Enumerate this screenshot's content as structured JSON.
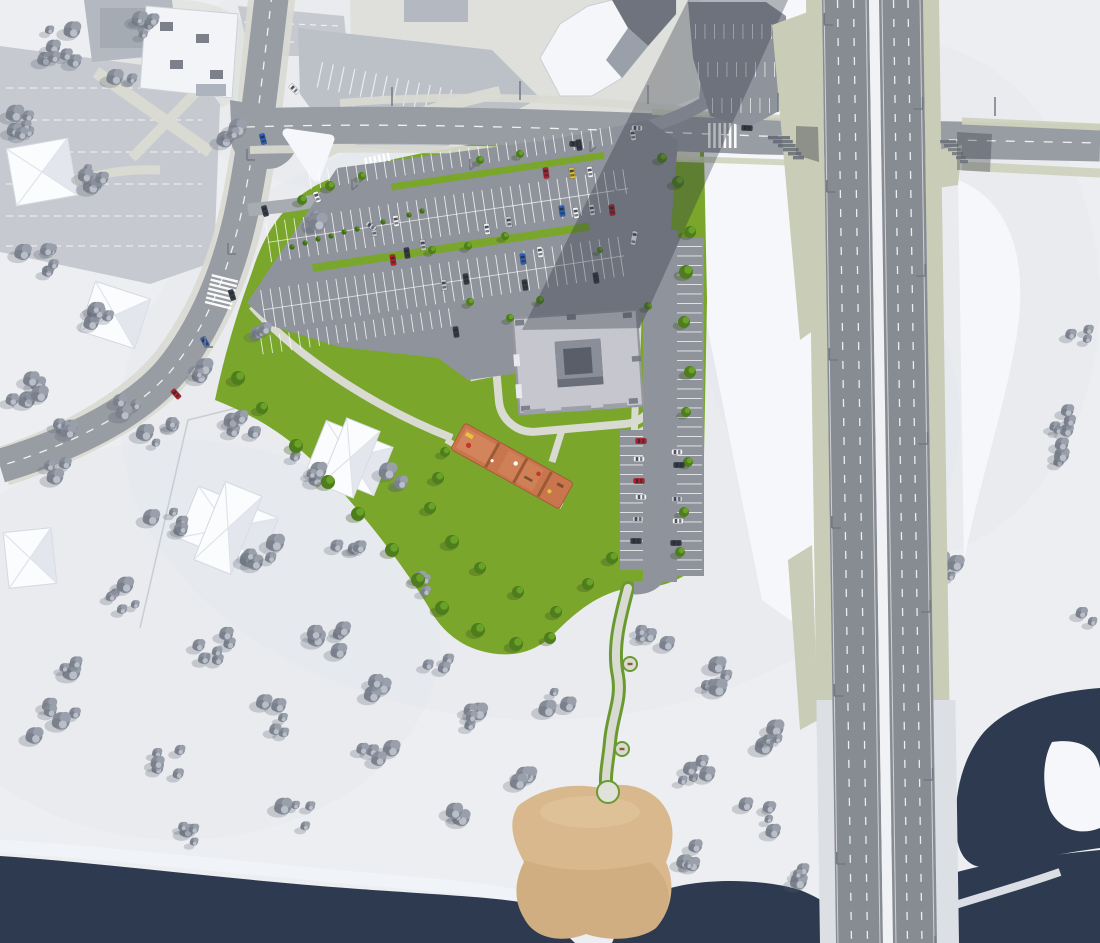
{
  "scene": {
    "description": "aerial-3d-site-plan-render",
    "season": "winter",
    "elements": [
      "river",
      "sand-beach",
      "elevated-highway-bridge",
      "parking-lot",
      "courtyard-apartment-building",
      "playground",
      "winding-riverside-path",
      "context-houses",
      "roads-with-crosswalks"
    ]
  },
  "colors": {
    "snow": "#eceef1",
    "snow_light": "#f5f7fa",
    "snow_shade": "#e0e4ea",
    "water": "#2d3a50",
    "sand": "#d8b88c",
    "sand_dark": "#c7a173",
    "sand_light": "#e2c79e",
    "grass": "#79a62b",
    "grass_dark": "#5e8f22",
    "bush": "#3f6b1a",
    "tree_green": "#4e7d1d",
    "tree_green_hi": "#6aa228",
    "tree_gray": "#868c97",
    "tree_gray_hi": "#b9bfc9",
    "tree_gray_dark": "#7b818c",
    "asphalt": "#8f939b",
    "asphalt_light": "#a7abb2",
    "road": "#989ca3",
    "bridge_road": "#878c93",
    "old_lot": "#c6cad0",
    "angle_lot": "#bcc0c7",
    "khaki": "#c9ccb6",
    "marking": "#f2f4f6",
    "walk": "#d9dad2",
    "plaza": "#dadbd3",
    "shadow": "rgba(45,51,64,0.34)",
    "roof": "#c6c6ce",
    "roof_edge": "#97979f",
    "court_dark": "#6a6e79",
    "court_mid": "#8a8e99",
    "court_hole": "#5a5e68",
    "bldg_white": "#f3f4f7",
    "roof_gray": "#b4b9c1",
    "roof_dark": "#6e737d",
    "house": "#fbfcfe",
    "house_shade": "#dde1e9",
    "pg_base": "#c9764f",
    "pg_light": "#d88a5f",
    "pg_red": "#c03a2b",
    "pg_yellow": "#e5c33c",
    "pg_brown": "#7d4f2e",
    "median": "#f0f2f5",
    "deck_edge": "#dcdfe4",
    "pole": "#747983"
  },
  "cars": {
    "palette": {
      "white": "#f4f5f7",
      "silver": "#c6cad1",
      "dark": "#383c44",
      "red": "#c01f2a",
      "yellow": "#e6c430",
      "blue": "#2b62c4"
    },
    "items": [
      [
        374,
        231,
        82,
        "silver",
        11
      ],
      [
        396,
        221,
        82,
        "white",
        11
      ],
      [
        487,
        229,
        82,
        "white",
        11
      ],
      [
        509,
        222,
        82,
        "silver",
        11
      ],
      [
        407,
        253,
        82,
        "dark",
        11
      ],
      [
        423,
        245,
        82,
        "silver",
        11
      ],
      [
        393,
        260,
        82,
        "red",
        11
      ],
      [
        523,
        259,
        82,
        "blue",
        11
      ],
      [
        540,
        252,
        82,
        "white",
        11
      ],
      [
        466,
        279,
        82,
        "dark",
        11
      ],
      [
        444,
        285,
        82,
        "silver",
        11
      ],
      [
        525,
        285,
        82,
        "dark",
        11
      ],
      [
        456,
        332,
        82,
        "dark",
        11
      ],
      [
        546,
        173,
        82,
        "red",
        11
      ],
      [
        572,
        173,
        82,
        "yellow",
        11
      ],
      [
        590,
        172,
        82,
        "white",
        11
      ],
      [
        592,
        210,
        82,
        "white",
        11
      ],
      [
        562,
        211,
        82,
        "blue",
        11
      ],
      [
        576,
        213,
        82,
        "white",
        11
      ],
      [
        612,
        210,
        82,
        "red",
        11
      ],
      [
        579,
        145,
        82,
        "dark",
        11
      ],
      [
        633,
        135,
        82,
        "white",
        11
      ],
      [
        596,
        278,
        82,
        "dark",
        11
      ],
      [
        634,
        238,
        100,
        "white",
        14
      ],
      [
        641,
        441,
        0,
        "red",
        11
      ],
      [
        639,
        459,
        0,
        "white",
        11
      ],
      [
        639,
        481,
        0,
        "red",
        11
      ],
      [
        641,
        497,
        0,
        "white",
        11
      ],
      [
        638,
        519,
        0,
        "silver",
        11
      ],
      [
        636,
        541,
        0,
        "dark",
        11
      ],
      [
        677,
        452,
        0,
        "white",
        11
      ],
      [
        679,
        465,
        0,
        "dark",
        11
      ],
      [
        677,
        499,
        0,
        "silver",
        11
      ],
      [
        678,
        521,
        0,
        "white",
        11
      ],
      [
        676,
        543,
        0,
        "dark",
        11
      ],
      [
        263,
        139,
        75,
        "blue",
        11
      ],
      [
        265,
        211,
        75,
        "dark",
        11
      ],
      [
        232,
        295,
        72,
        "dark",
        11
      ],
      [
        205,
        342,
        62,
        "blue",
        11
      ],
      [
        176,
        394,
        48,
        "red",
        11
      ],
      [
        317,
        197,
        70,
        "white",
        11
      ],
      [
        294,
        89,
        45,
        "white",
        11
      ],
      [
        371,
        226,
        35,
        "silver",
        11
      ],
      [
        637,
        128,
        2,
        "white",
        11
      ],
      [
        575,
        144,
        2,
        "dark",
        11
      ],
      [
        747,
        128,
        2,
        "dark",
        11
      ]
    ]
  },
  "vegetation": {
    "gray_clusters": [
      [
        55,
        45,
        7,
        40
      ],
      [
        140,
        28,
        5,
        26
      ],
      [
        25,
        120,
        6,
        32
      ],
      [
        90,
        178,
        6,
        36
      ],
      [
        38,
        258,
        5,
        34
      ],
      [
        100,
        318,
        5,
        30
      ],
      [
        28,
        392,
        5,
        36
      ],
      [
        120,
        70,
        3,
        24
      ],
      [
        230,
        132,
        3,
        20
      ],
      [
        320,
        222,
        3,
        18
      ],
      [
        262,
        332,
        3,
        16
      ],
      [
        205,
        372,
        3,
        16
      ],
      [
        60,
        430,
        4,
        30
      ],
      [
        130,
        404,
        3,
        22
      ],
      [
        158,
        432,
        5,
        30
      ],
      [
        248,
        420,
        5,
        34
      ],
      [
        306,
        468,
        4,
        28
      ],
      [
        168,
        520,
        5,
        34
      ],
      [
        258,
        558,
        5,
        36
      ],
      [
        348,
        540,
        4,
        30
      ],
      [
        118,
        598,
        5,
        36
      ],
      [
        218,
        648,
        6,
        40
      ],
      [
        326,
        640,
        5,
        36
      ],
      [
        420,
        582,
        3,
        24
      ],
      [
        438,
        668,
        3,
        22
      ],
      [
        398,
        478,
        3,
        22
      ],
      [
        60,
        470,
        3,
        22
      ],
      [
        55,
        722,
        5,
        44
      ],
      [
        158,
        760,
        5,
        44
      ],
      [
        276,
        718,
        5,
        40
      ],
      [
        376,
        758,
        4,
        36
      ],
      [
        472,
        720,
        4,
        30
      ],
      [
        298,
        820,
        4,
        40
      ],
      [
        178,
        838,
        4,
        36
      ],
      [
        516,
        778,
        3,
        24
      ],
      [
        556,
        700,
        3,
        24
      ],
      [
        456,
        818,
        3,
        22
      ],
      [
        64,
        662,
        3,
        26
      ],
      [
        380,
        690,
        3,
        24
      ],
      [
        652,
        638,
        4,
        30
      ],
      [
        716,
        678,
        5,
        36
      ],
      [
        698,
        768,
        5,
        36
      ],
      [
        756,
        818,
        5,
        36
      ],
      [
        688,
        858,
        4,
        30
      ],
      [
        774,
        738,
        4,
        26
      ],
      [
        856,
        778,
        4,
        30
      ],
      [
        896,
        838,
        3,
        26
      ],
      [
        806,
        878,
        3,
        22
      ],
      [
        1062,
        416,
        5,
        36
      ],
      [
        1078,
        330,
        3,
        22
      ],
      [
        952,
        566,
        4,
        28
      ],
      [
        1070,
        452,
        3,
        24
      ],
      [
        1086,
        620,
        2,
        18
      ]
    ],
    "green_trees": [
      [
        238,
        378,
        7
      ],
      [
        262,
        408,
        6
      ],
      [
        296,
        446,
        7
      ],
      [
        328,
        482,
        7
      ],
      [
        358,
        514,
        7
      ],
      [
        392,
        550,
        7
      ],
      [
        418,
        580,
        7
      ],
      [
        442,
        608,
        7
      ],
      [
        478,
        630,
        7
      ],
      [
        516,
        644,
        7
      ],
      [
        550,
        638,
        6
      ],
      [
        438,
        478,
        6
      ],
      [
        430,
        508,
        6
      ],
      [
        452,
        542,
        7
      ],
      [
        480,
        568,
        6
      ],
      [
        518,
        592,
        6
      ],
      [
        556,
        612,
        6
      ],
      [
        588,
        584,
        6
      ],
      [
        612,
        558,
        6
      ],
      [
        445,
        452,
        5
      ],
      [
        510,
        318,
        4
      ],
      [
        648,
        306,
        4
      ],
      [
        678,
        182,
        6
      ],
      [
        690,
        232,
        6
      ],
      [
        686,
        272,
        7
      ],
      [
        684,
        322,
        6
      ],
      [
        690,
        372,
        6
      ],
      [
        686,
        412,
        5
      ],
      [
        688,
        462,
        5
      ],
      [
        684,
        512,
        5
      ],
      [
        680,
        552,
        5
      ],
      [
        662,
        158,
        5
      ],
      [
        302,
        200,
        5
      ],
      [
        330,
        186,
        5
      ],
      [
        362,
        176,
        4
      ],
      [
        505,
        236,
        4
      ],
      [
        468,
        246,
        4
      ],
      [
        540,
        300,
        4
      ],
      [
        470,
        302,
        4
      ],
      [
        600,
        250,
        3
      ],
      [
        480,
        160,
        4
      ],
      [
        520,
        154,
        4
      ],
      [
        432,
        250,
        4
      ]
    ],
    "bushes": [
      [
        292,
        247
      ],
      [
        305,
        243
      ],
      [
        318,
        239
      ],
      [
        331,
        236
      ],
      [
        344,
        232
      ],
      [
        357,
        229
      ],
      [
        370,
        225
      ],
      [
        383,
        222
      ],
      [
        396,
        218
      ],
      [
        409,
        215
      ],
      [
        422,
        211
      ]
    ]
  },
  "street_furniture": {
    "light_poles": [
      [
        247,
        160,
        8,
        0
      ],
      [
        228,
        254,
        8,
        0
      ],
      [
        205,
        347,
        8,
        0
      ],
      [
        392,
        98,
        0,
        8
      ],
      [
        520,
        92,
        0,
        8
      ],
      [
        648,
        96,
        0,
        8
      ],
      [
        778,
        104,
        0,
        8
      ],
      [
        995,
        108,
        0,
        8
      ],
      [
        352,
        190,
        6,
        -5
      ],
      [
        470,
        170,
        6,
        -5
      ],
      [
        590,
        152,
        6,
        -5
      ]
    ],
    "bridge_pole_y": [
      25,
      192,
      360,
      528,
      696,
      864
    ],
    "crosswalk_count": 3,
    "bench_spots": [
      [
        630,
        664
      ],
      [
        622,
        749
      ]
    ]
  }
}
